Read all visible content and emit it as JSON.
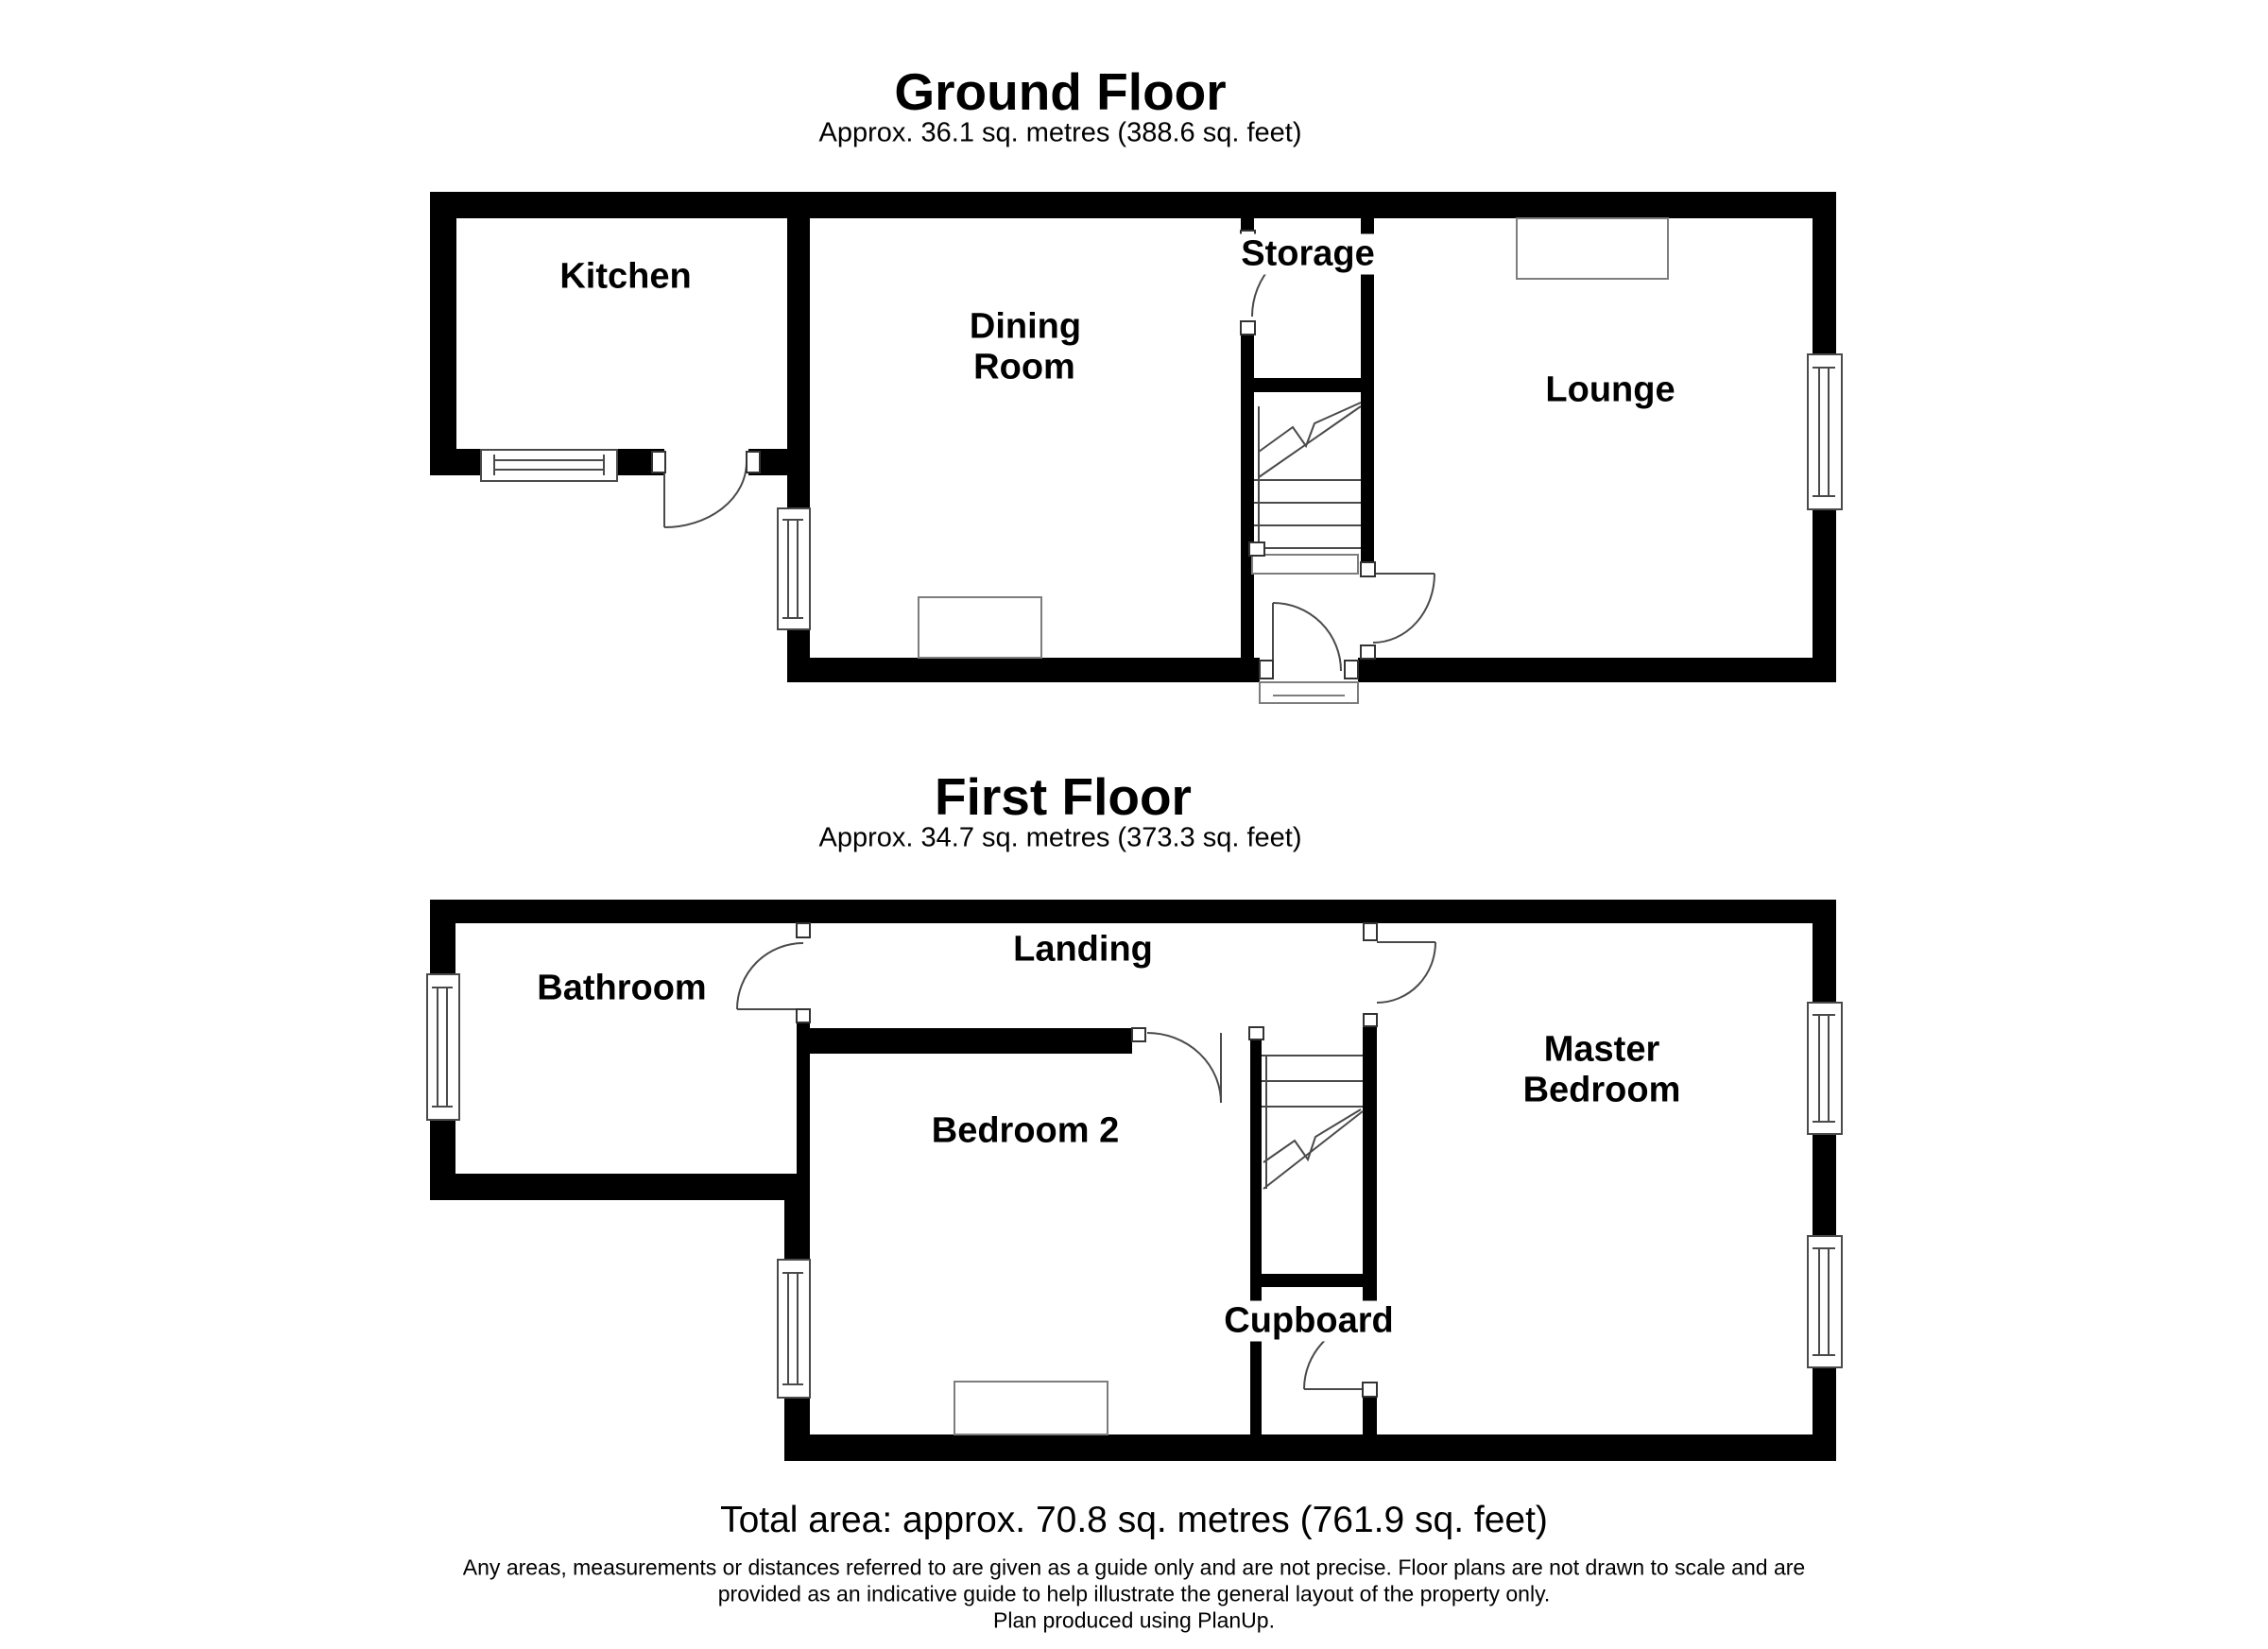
{
  "page": {
    "background": "#ffffff",
    "wall_color": "#000000",
    "line_color": "#4a4a4a",
    "furniture_line_color": "#7d7d7d",
    "text_color": "#000000"
  },
  "ground_floor": {
    "title": "Ground Floor",
    "subtitle": "Approx. 36.1 sq. metres (388.6 sq. feet)",
    "labels": {
      "kitchen": "Kitchen",
      "dining_line1": "Dining",
      "dining_line2": "Room",
      "storage": "Storage",
      "lounge": "Lounge"
    }
  },
  "first_floor": {
    "title": "First Floor",
    "subtitle": "Approx. 34.7 sq. metres (373.3 sq. feet)",
    "labels": {
      "bathroom": "Bathroom",
      "landing": "Landing",
      "bedroom2": "Bedroom 2",
      "master_line1": "Master",
      "master_line2": "Bedroom",
      "cupboard": "Cupboard"
    }
  },
  "footer": {
    "total_area": "Total area: approx. 70.8 sq. metres (761.9 sq. feet)",
    "disclaimer_line1": "Any areas, measurements or distances referred to are given as a guide only and are not precise. Floor plans are not drawn to scale and are",
    "disclaimer_line2": "provided as an indicative guide to help illustrate the general layout of the property only.",
    "disclaimer_line3": "Plan produced using PlanUp."
  }
}
